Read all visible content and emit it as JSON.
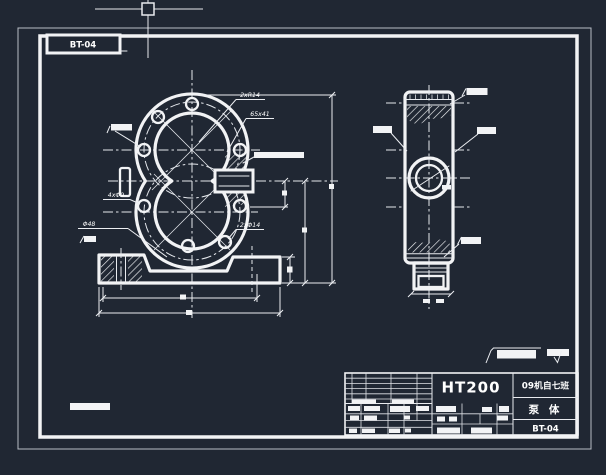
{
  "app": {
    "background_color": "#202733",
    "line_color": "#f2f3f5"
  },
  "sheet": {
    "tab_label": "BT-04"
  },
  "front_view": {
    "labels": {
      "top_holes": "2xR14",
      "port_note": "65x41",
      "side_holes": "4xΦ9",
      "boss_diameter": "Φ48",
      "bottom_holes": "2xΦ14"
    }
  },
  "title_block": {
    "material": "HT200",
    "class_name": "09机自七班",
    "part_name": "泵 体",
    "drawing_number": "BT-04"
  }
}
